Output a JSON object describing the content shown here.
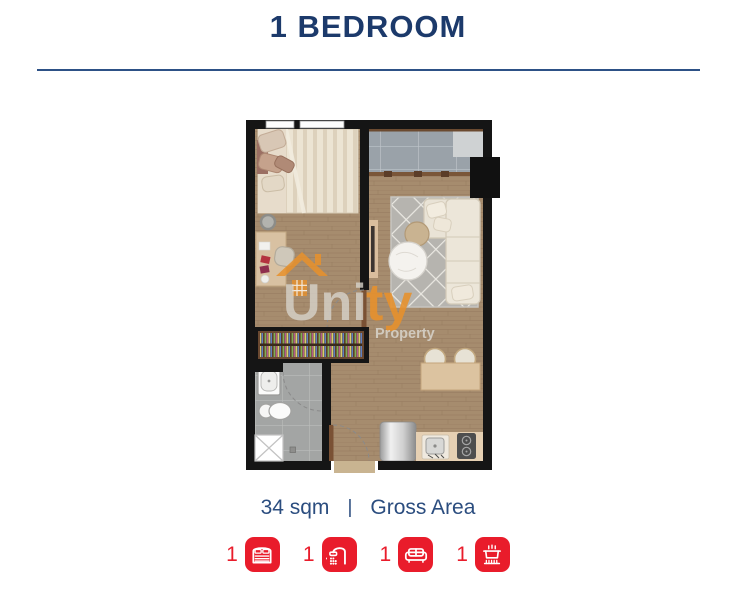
{
  "header": {
    "title": "1 BEDROOM"
  },
  "floorplan": {
    "watermark": {
      "brand_gray": "Uni",
      "brand_orange": "ty",
      "subtitle": "Property"
    }
  },
  "area": {
    "value": "34 sqm",
    "separator": "|",
    "label": "Gross Area"
  },
  "features": [
    {
      "count": "1",
      "icon": "bed-icon"
    },
    {
      "count": "1",
      "icon": "shower-icon"
    },
    {
      "count": "1",
      "icon": "sofa-icon"
    },
    {
      "count": "1",
      "icon": "kitchen-icon"
    }
  ],
  "colors": {
    "title_navy": "#1c3a6b",
    "rule_blue": "#2d5186",
    "area_text_blue": "#2b4d7f",
    "accent_red": "#e91c2b",
    "watermark_orange": "#e8912c"
  }
}
